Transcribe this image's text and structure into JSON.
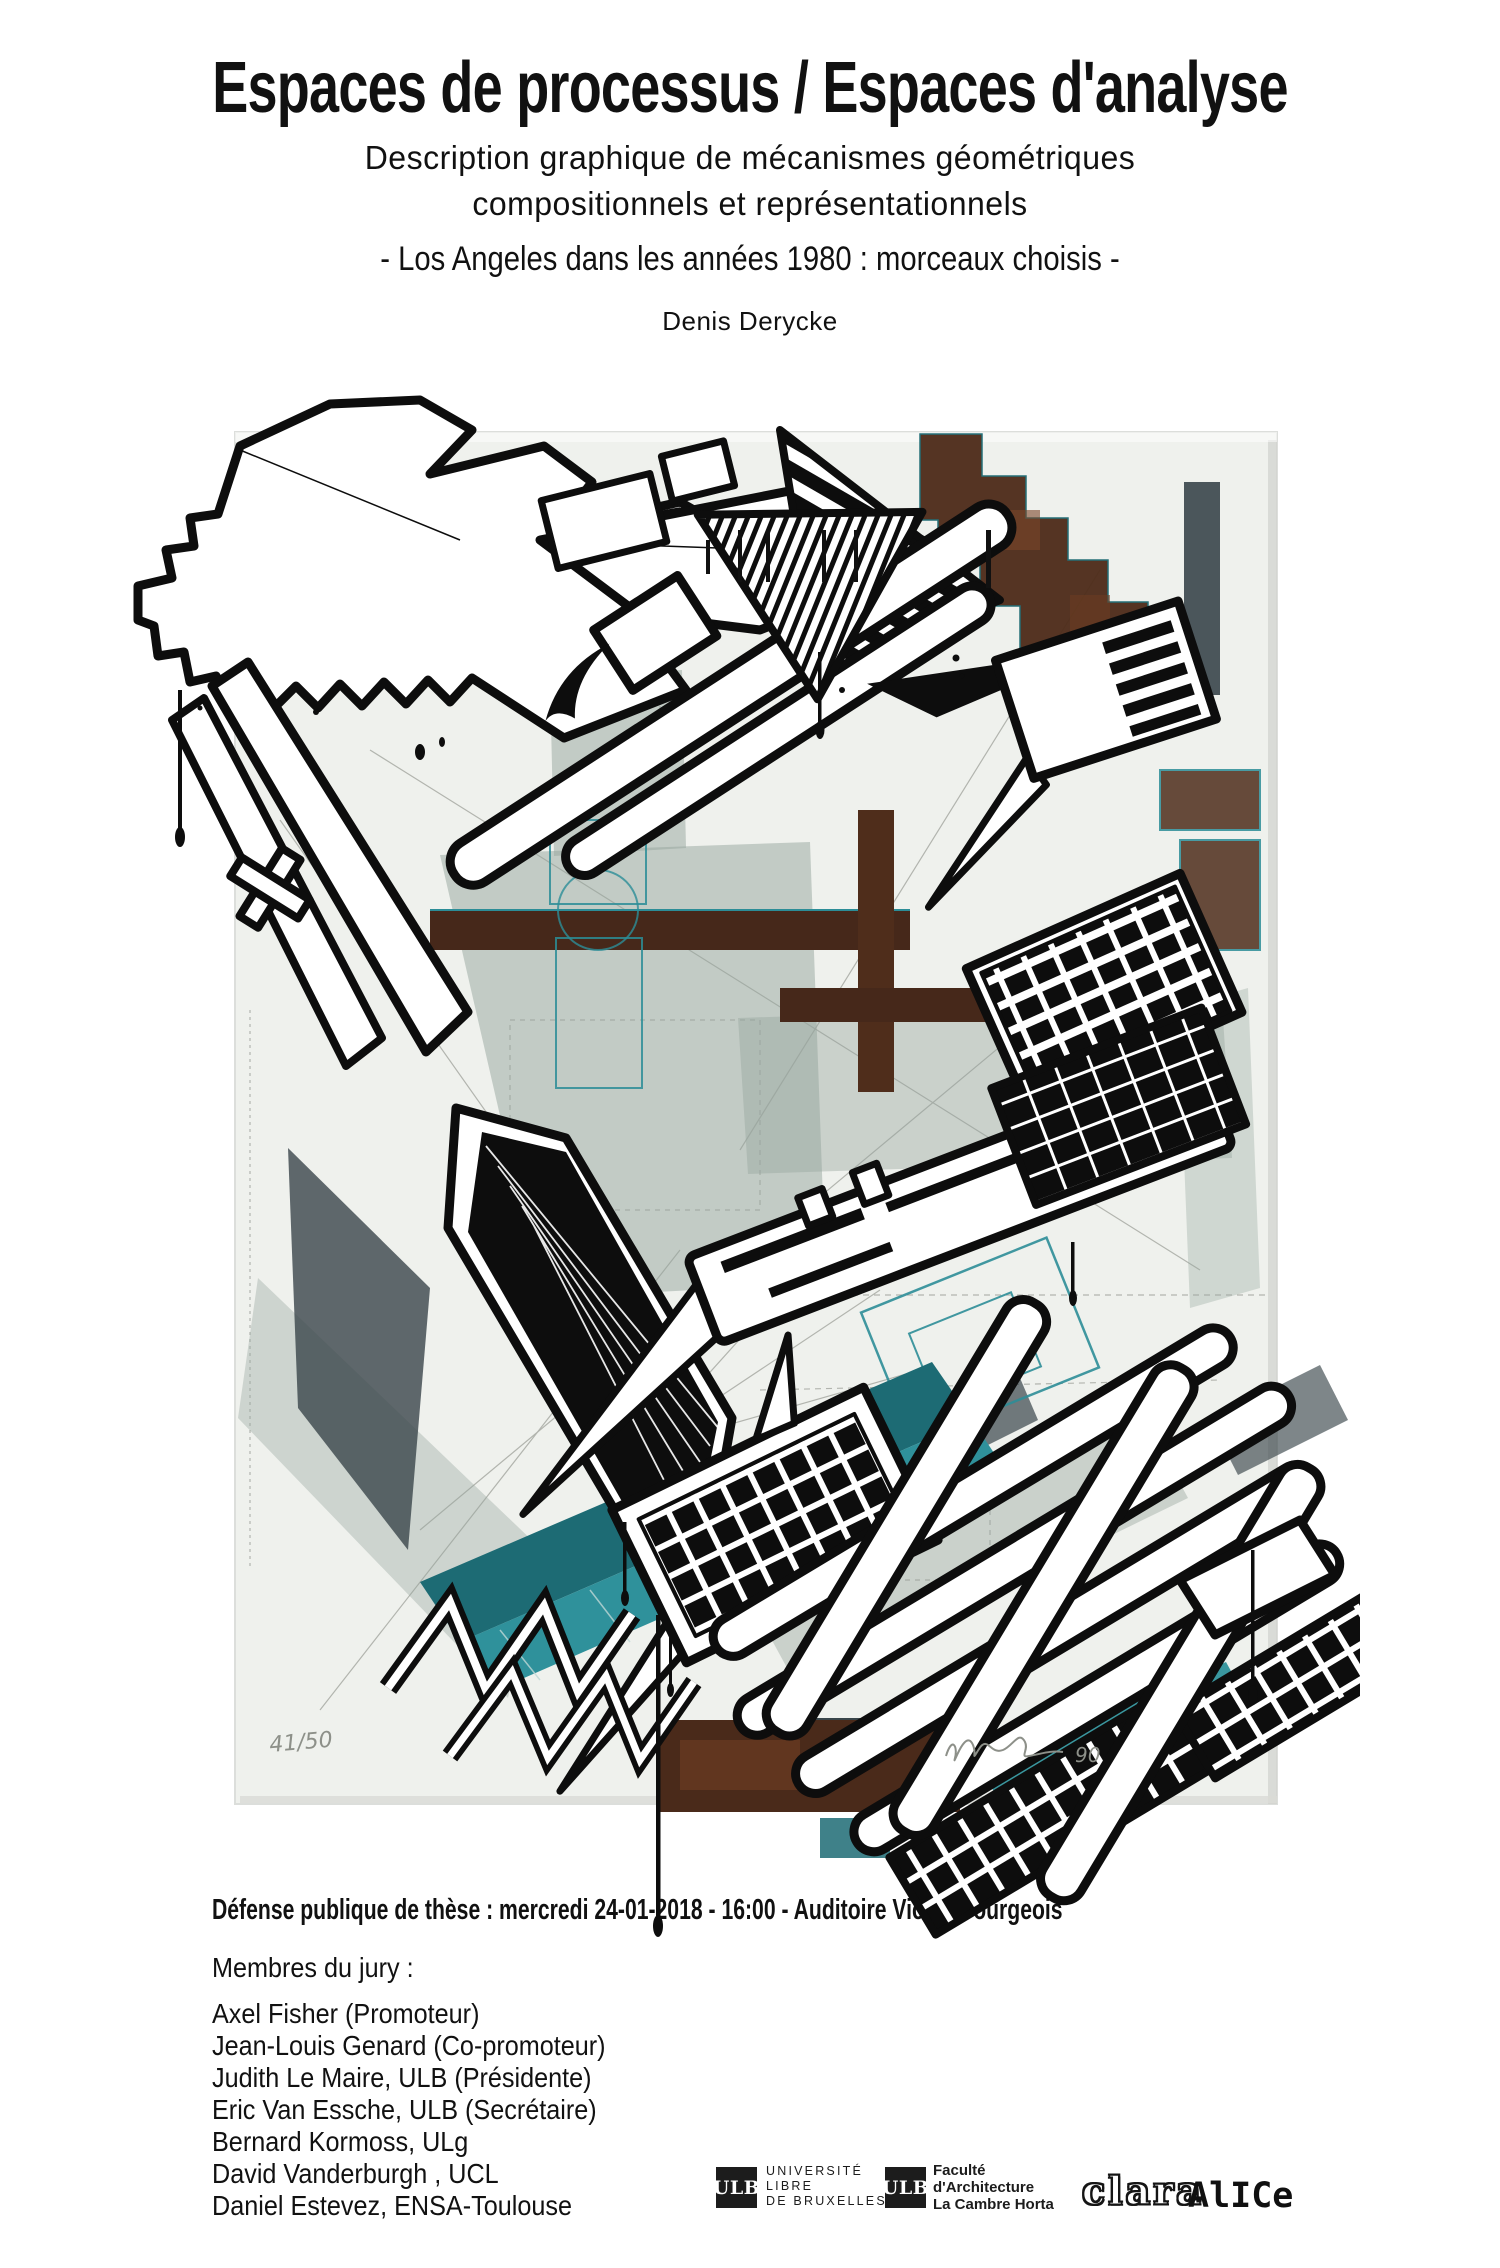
{
  "header": {
    "title": "Espaces de processus / Espaces d'analyse",
    "subtitle_line1": "Description graphique de mécanismes géométriques",
    "subtitle_line2": "compositionnels et représentationnels",
    "tagline": "- Los Angeles dans les années 1980 : morceaux choisis -",
    "author": "Denis Derycke"
  },
  "artwork": {
    "description": "Abstract axonometric architectural screen print collage (Los Angeles), black ink shapes with paint drips over sage, teal and rust structures on an off-white paper sheet",
    "edition_mark": "41/50",
    "year_mark": "90",
    "palette": {
      "paper": "#eff1ed",
      "ink": "#0d0d0d",
      "sage": "#96a59d",
      "slate": "#39454a",
      "teal": "#2f919b",
      "teal_dark": "#1d6b74",
      "rust": "#46281a",
      "rust_light": "#7a4628",
      "pencil": "#8d9089"
    }
  },
  "event": {
    "defense_line": "Défense publique de thèse : mercredi 24-01-2018 - 16:00 - Auditoire Victor Bourgeois"
  },
  "jury": {
    "heading": "Membres du jury :",
    "members": [
      "Axel Fisher (Promoteur)",
      "Jean-Louis Genard (Co-promoteur)",
      "Judith Le Maire, ULB (Présidente)",
      "Eric Van Essche, ULB (Secrétaire)",
      "Bernard Kormoss, ULg",
      "David Vanderburgh , UCL",
      "Daniel Estevez, ENSA-Toulouse"
    ]
  },
  "logos": {
    "ulb": {
      "abbr": "ULB",
      "line1": "UNIVERSITÉ",
      "line2": "LIBRE",
      "line3": "DE BRUXELLES"
    },
    "faculty": {
      "abbr": "ULB",
      "line1": "Faculté",
      "line2": "d'Architecture",
      "line3": "La Cambre Horta"
    },
    "clara_label": "clara",
    "alice_label": "AlICe"
  }
}
